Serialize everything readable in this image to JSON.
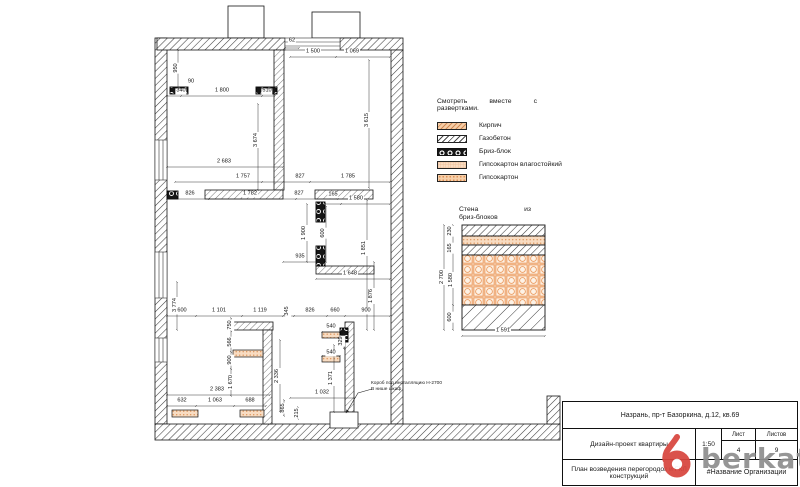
{
  "legend": {
    "note_line1": "Смотреть вместе с",
    "note_line2": "развертками.",
    "items": [
      {
        "label": "Кирпич",
        "pattern": "brick"
      },
      {
        "label": "Газобетон",
        "pattern": "aerated"
      },
      {
        "label": "Бриз-блок",
        "pattern": "briz"
      },
      {
        "label": "Гипсокартон влагостойкий",
        "pattern": "gkl-moist"
      },
      {
        "label": "Гипсокартон",
        "pattern": "gkl"
      }
    ]
  },
  "detail": {
    "title_word1": "Стена",
    "title_word2": "из",
    "title_line2": "бриз-блоков"
  },
  "plan": {
    "note_line1": "Короб под инсталляцию Н-2700",
    "note_line2": "В нише шкаф",
    "dimensions": [
      {
        "t": "62",
        "x": 292,
        "y": 44,
        "r": 0
      },
      {
        "t": "1 500",
        "x": 313,
        "y": 55,
        "r": 0
      },
      {
        "t": "1 069",
        "x": 352,
        "y": 55,
        "r": 0
      },
      {
        "t": "950",
        "x": 177,
        "y": 68,
        "r": 1
      },
      {
        "t": "90",
        "x": 191,
        "y": 85,
        "r": 0
      },
      {
        "t": "340",
        "x": 181,
        "y": 94,
        "r": 0
      },
      {
        "t": "1 800",
        "x": 222,
        "y": 94,
        "r": 0
      },
      {
        "t": "510",
        "x": 267,
        "y": 94,
        "r": 0
      },
      {
        "t": "3 674",
        "x": 257,
        "y": 140,
        "r": 1
      },
      {
        "t": "3 615",
        "x": 368,
        "y": 120,
        "r": 1
      },
      {
        "t": "2 683",
        "x": 224,
        "y": 165,
        "r": 0
      },
      {
        "t": "1 757",
        "x": 243,
        "y": 180,
        "r": 0
      },
      {
        "t": "827",
        "x": 300,
        "y": 180,
        "r": 0
      },
      {
        "t": "1 785",
        "x": 348,
        "y": 180,
        "r": 0
      },
      {
        "t": "826",
        "x": 190,
        "y": 197,
        "r": 0
      },
      {
        "t": "1 782",
        "x": 250,
        "y": 197,
        "r": 0
      },
      {
        "t": "827",
        "x": 299,
        "y": 197,
        "r": 0
      },
      {
        "t": "165",
        "x": 333,
        "y": 198,
        "r": 0
      },
      {
        "t": "1 580",
        "x": 356,
        "y": 202,
        "r": 0
      },
      {
        "t": "1 900",
        "x": 305,
        "y": 233,
        "r": 1
      },
      {
        "t": "600",
        "x": 324,
        "y": 233,
        "r": 1
      },
      {
        "t": "1 851",
        "x": 365,
        "y": 248,
        "r": 1
      },
      {
        "t": "935",
        "x": 300,
        "y": 260,
        "r": 0
      },
      {
        "t": "1 648",
        "x": 350,
        "y": 277,
        "r": 0
      },
      {
        "t": "1 876",
        "x": 372,
        "y": 296,
        "r": 1
      },
      {
        "t": "3 774",
        "x": 176,
        "y": 305,
        "r": 1
      },
      {
        "t": "600",
        "x": 182,
        "y": 314,
        "r": 0
      },
      {
        "t": "1 101",
        "x": 219,
        "y": 314,
        "r": 0
      },
      {
        "t": "1 119",
        "x": 260,
        "y": 314,
        "r": 0
      },
      {
        "t": "345",
        "x": 288,
        "y": 311,
        "r": 1
      },
      {
        "t": "826",
        "x": 310,
        "y": 314,
        "r": 0
      },
      {
        "t": "660",
        "x": 335,
        "y": 314,
        "r": 0
      },
      {
        "t": "900",
        "x": 366,
        "y": 314,
        "r": 0
      },
      {
        "t": "750",
        "x": 231,
        "y": 325,
        "r": 1
      },
      {
        "t": "566",
        "x": 231,
        "y": 342,
        "r": 1
      },
      {
        "t": "900",
        "x": 231,
        "y": 360,
        "r": 1
      },
      {
        "t": "1 670",
        "x": 232,
        "y": 382,
        "r": 1
      },
      {
        "t": "2 336",
        "x": 278,
        "y": 376,
        "r": 1
      },
      {
        "t": "1 371",
        "x": 332,
        "y": 378,
        "r": 1
      },
      {
        "t": "540",
        "x": 331,
        "y": 330,
        "r": 0
      },
      {
        "t": "540",
        "x": 331,
        "y": 356,
        "r": 0
      },
      {
        "t": "329",
        "x": 342,
        "y": 341,
        "r": 1
      },
      {
        "t": "2 383",
        "x": 217,
        "y": 393,
        "r": 0
      },
      {
        "t": "1 032",
        "x": 322,
        "y": 396,
        "r": 0
      },
      {
        "t": "632",
        "x": 182,
        "y": 404,
        "r": 0
      },
      {
        "t": "1 063",
        "x": 215,
        "y": 404,
        "r": 0
      },
      {
        "t": "688",
        "x": 250,
        "y": 404,
        "r": 0
      },
      {
        "t": "865",
        "x": 284,
        "y": 408,
        "r": 1
      },
      {
        "t": "215",
        "x": 298,
        "y": 413,
        "r": 1
      },
      {
        "t": "230",
        "x": 451,
        "y": 231,
        "r": 1
      },
      {
        "t": "165",
        "x": 451,
        "y": 248,
        "r": 1
      },
      {
        "t": "2 700",
        "x": 443,
        "y": 277,
        "r": 1
      },
      {
        "t": "1 580",
        "x": 452,
        "y": 280,
        "r": 1
      },
      {
        "t": "600",
        "x": 451,
        "y": 317,
        "r": 1
      },
      {
        "t": "1 591",
        "x": 503,
        "y": 334,
        "r": 0
      }
    ]
  },
  "title_block": {
    "address": "Назрань, пр-т Базоркина, д.12, кв.69",
    "project": "Дизайн-проект квартиры",
    "scale": "1:50",
    "sheet_label": "Лист",
    "sheet": "4",
    "sheets_label": "Листов",
    "sheets": "9",
    "drawing_title": "План возведения перегородок и ГКЛ конструкций",
    "organization": "#Название Организации"
  },
  "watermark": {
    "text": "berkat.",
    "text_color": "#8f8f8f",
    "accent_color": "#d8453e"
  }
}
